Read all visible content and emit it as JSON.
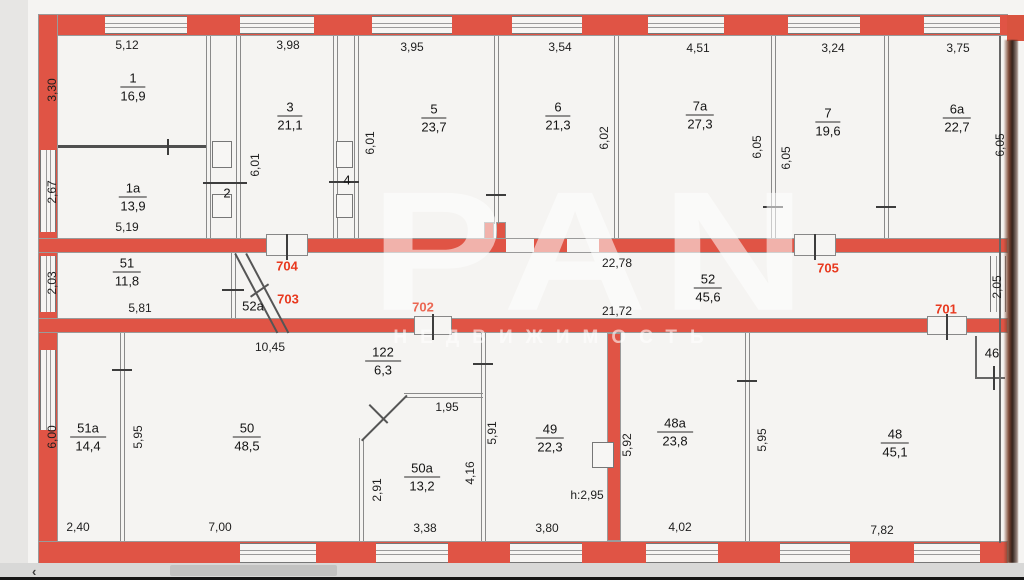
{
  "plan": {
    "rooms": [
      {
        "n": "1",
        "a": "16,9"
      },
      {
        "n": "1а",
        "a": "13,9"
      },
      {
        "n": "2"
      },
      {
        "n": "3",
        "a": "21,1"
      },
      {
        "n": "4"
      },
      {
        "n": "5",
        "a": "23,7"
      },
      {
        "n": "6",
        "a": "21,3"
      },
      {
        "n": "7а",
        "a": "27,3"
      },
      {
        "n": "7",
        "a": "19,6"
      },
      {
        "n": "6а",
        "a": "22,7"
      },
      {
        "n": "51",
        "a": "11,8"
      },
      {
        "n": "52а"
      },
      {
        "n": "52",
        "a": "45,6"
      },
      {
        "n": "51а",
        "a": "14,4"
      },
      {
        "n": "50",
        "a": "48,5"
      },
      {
        "n": "122",
        "a": "6,3"
      },
      {
        "n": "50а",
        "a": "13,2"
      },
      {
        "n": "49",
        "a": "22,3"
      },
      {
        "n": "48а",
        "a": "23,8"
      },
      {
        "n": "48",
        "a": "45,1"
      },
      {
        "n": "46"
      }
    ],
    "dims": [
      "5,12",
      "3,30",
      "2,67",
      "5,19",
      "3,98",
      "6,01",
      "3,95",
      "6,01",
      "3,54",
      "6,02",
      "4,51",
      "3,24",
      "3,75",
      "6,05",
      "6,05",
      "6,05",
      "2,03",
      "5,81",
      "22,78",
      "21,72",
      "2,05",
      "10,45",
      "6,00",
      "5,95",
      "2,40",
      "7,00",
      "1,95",
      "2,91",
      "4,16",
      "5,91",
      "3,38",
      "3,80",
      "5,92",
      "5,95",
      "4,02",
      "7,82",
      "h:2,95"
    ],
    "door_labels": [
      "704",
      "703",
      "702",
      "705",
      "701"
    ]
  },
  "watermark": {
    "logo": "PAN",
    "subtitle": "НЕДВИЖИМОСТЬ"
  },
  "viewer": {
    "back": "‹"
  },
  "colors": {
    "wall": "#e05445",
    "door_label": "#e8391f"
  }
}
